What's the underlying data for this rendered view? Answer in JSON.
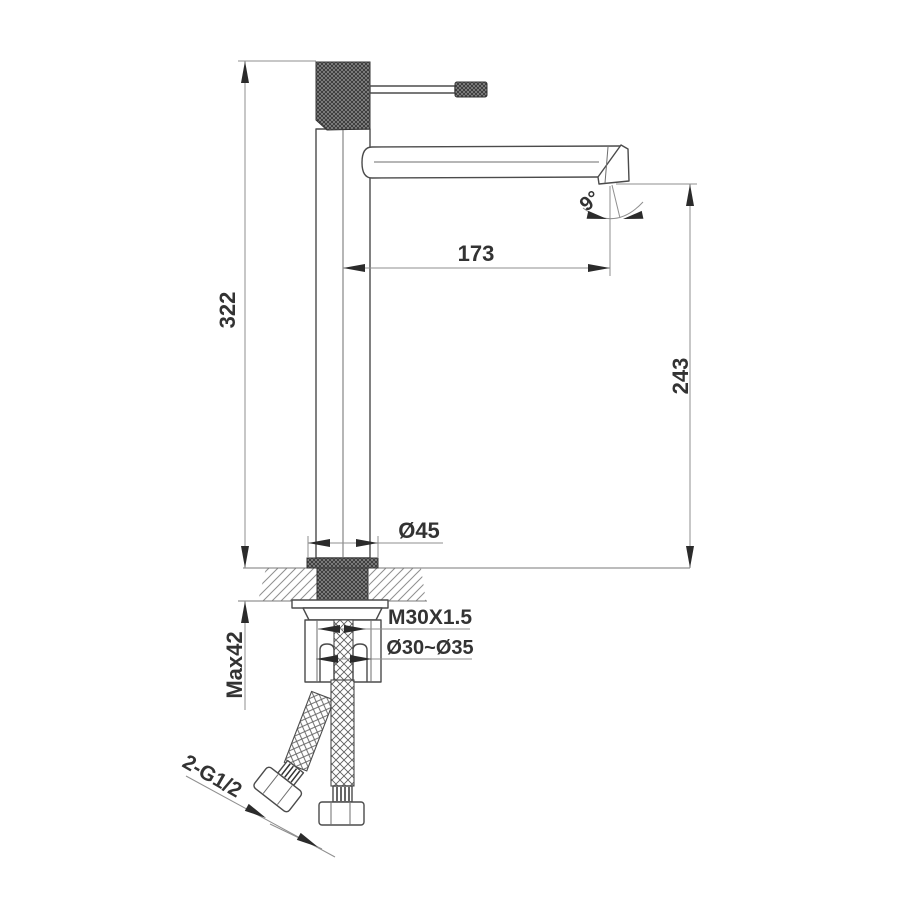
{
  "drawing": {
    "type": "technical-drawing",
    "subject": "tall single-lever basin mixer faucet, side elevation with installation section",
    "dimensions": {
      "overall_height": "322",
      "spout_reach": "173",
      "spout_height": "243",
      "spout_angle": "9°",
      "base_diameter": "Ø45",
      "thread_spec": "M30X1.5",
      "hole_diameter": "Ø30~Ø35",
      "max_deck_thickness": "Max42",
      "hose_thread": "2-G1/2"
    },
    "colors": {
      "outline": "#4b4b4b",
      "dimension": "#8f8f8f",
      "text": "#333333",
      "background": "#ffffff"
    }
  }
}
